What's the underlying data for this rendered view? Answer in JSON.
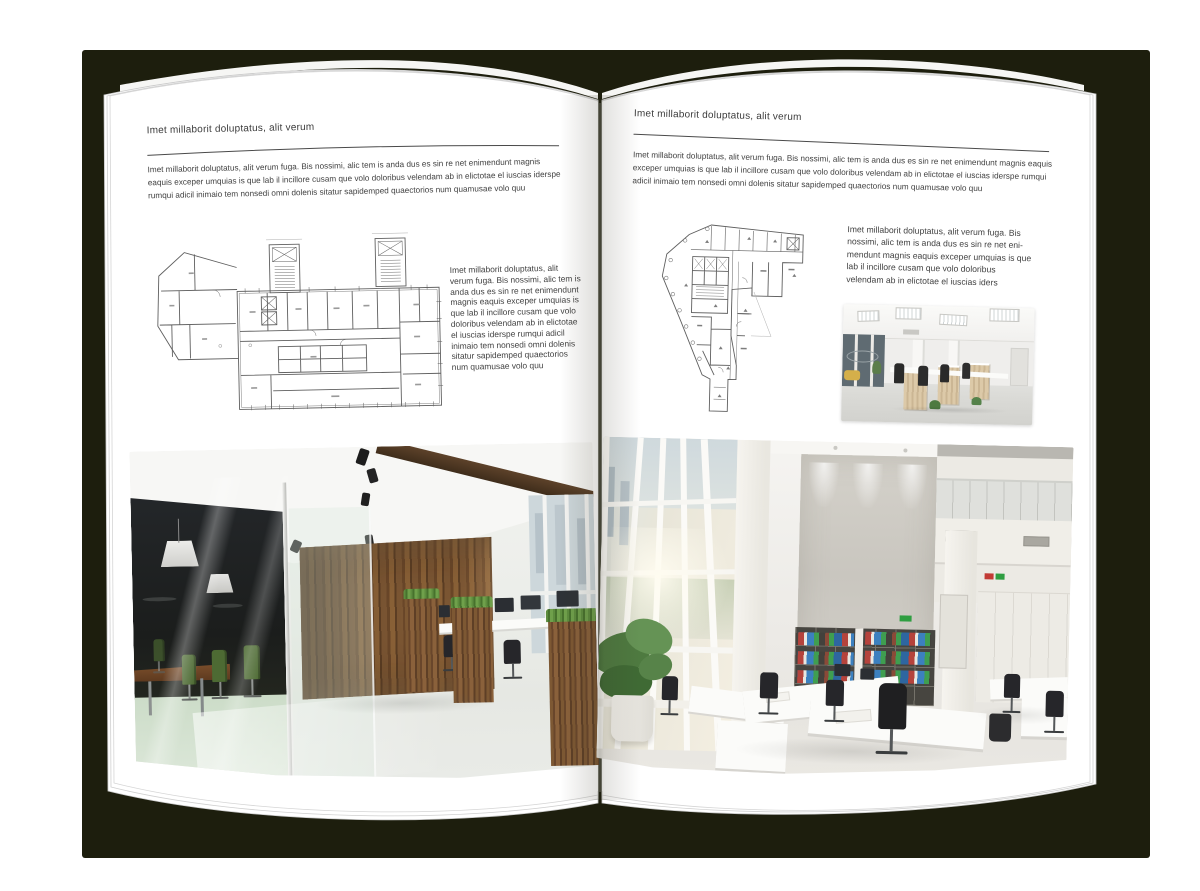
{
  "left": {
    "header": "Imet millaborit doluptatus, alit verum",
    "intro": "Imet millaborit doluptatus, alit verum fuga. Bis nossimi, alic tem is anda dus es sin re net enimendunt magnis eaquis exceper umquias is que lab il incillore cusam que volo doloribus velendam ab in elictotae el iuscias iderspe rumqui adicil inimaio tem nonsedi omni dolenis sitatur sapidemped quaectorios num quamusae volo quu",
    "caption": "Imet millaborit doluptatus, alit verum fuga. Bis nossimi, alic tem is anda dus es sin re net enimendunt magnis eaquis exceper umquias is que lab il incillore cusam que volo doloribus velendam ab in elictotae el iuscias iderspe rumqui adicil inimaio tem nonsedi omni dolenis sitatur sapidemped quaectorios num quamusae volo quu",
    "figures": {
      "floor_plan": "architectural-floor-plan-wide-building",
      "photo": "office-interior-dark-wood-glass-meeting-room"
    }
  },
  "right": {
    "header": "Imet millaborit doluptatus, alit verum",
    "intro": "Imet millaborit doluptatus, alit verum fuga. Bis nossimi, alic tem is anda dus es sin re net enimendunt magnis eaquis exceper umquias is que lab il incillore cusam que volo doloribus velendam ab in elictotae el iuscias iderspe rumqui adicil inimaio tem nonsedi omni dolenis sitatur sapidemped quaectorios num quamusae volo quu",
    "caption": "Imet millaborit doluptatus, alit verum fuga. Bis nossimi, alic tem is anda dus es sin re net eni- mendunt magnis eaquis exceper umquias is que lab il incillore cusam que volo doloribus velendam ab in elictotae el iuscias iders",
    "figures": {
      "floor_plan": "architectural-floor-plan-irregular-building",
      "photo_small": "open-office-cubicles-interior",
      "photo_large": "bright-tall-office-interior-bookshelves"
    }
  },
  "colors": {
    "cover": "#1d1e0d",
    "page": "#ffffff",
    "text": "#424242",
    "wood": "#7d5833",
    "chair_green": "#4d6a33",
    "binder_red": "#b5433c",
    "binder_green": "#3f9e50",
    "binder_blue": "#3c80bf"
  }
}
